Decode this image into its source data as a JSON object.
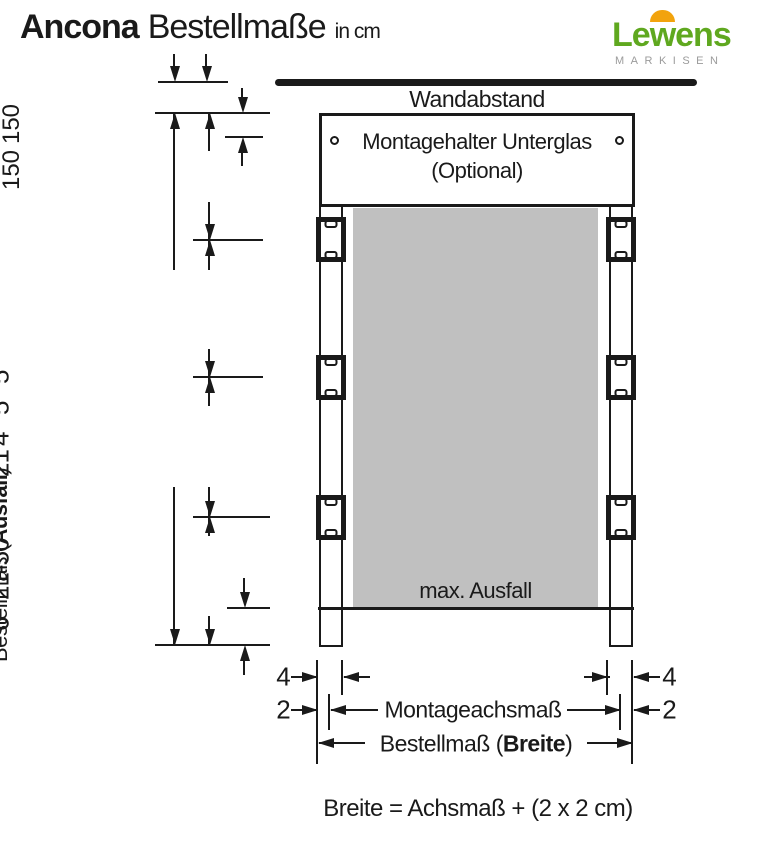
{
  "header": {
    "title": "Ancona",
    "subtitle": "Bestellmaße",
    "unit": "in cm"
  },
  "logo": {
    "text_pre": "Le",
    "text_w": "w",
    "text_post": "ens",
    "tagline": "MARKISEN"
  },
  "diagram": {
    "wall_label": "Wandabstand",
    "holder_line1": "Montagehalter Unterglas",
    "holder_line2": "(Optional)",
    "panel_label": "max. Ausfall",
    "left_dims": {
      "d5a": "5",
      "d5b": "5",
      "d4": "4",
      "d21": "21",
      "d150a_1": "max.",
      "d150a_2": "150",
      "d150b_1": "max.",
      "d150b_2": "150",
      "d21_50": "21-50",
      "d6": "6",
      "ausfall_pre": "Bestellmaß (",
      "ausfall_bold": "Ausfall",
      "ausfall_post": ")"
    },
    "bottom_dims": {
      "d4_left": "4",
      "d4_right": "4",
      "d2_left": "2",
      "d2_right": "2",
      "achsmass": "Montageachsmaß",
      "breite_pre": "Bestellmaß (",
      "breite_bold": "Breite",
      "breite_post": ")"
    }
  },
  "formula": "Breite = Achsmaß + (2 x 2 cm)",
  "colors": {
    "line": "#1a1a1a",
    "panel_gray": "#c0c0c0",
    "logo_green": "#5fa81f",
    "logo_orange": "#f2a30d",
    "logo_gray": "#9b9b9b"
  }
}
